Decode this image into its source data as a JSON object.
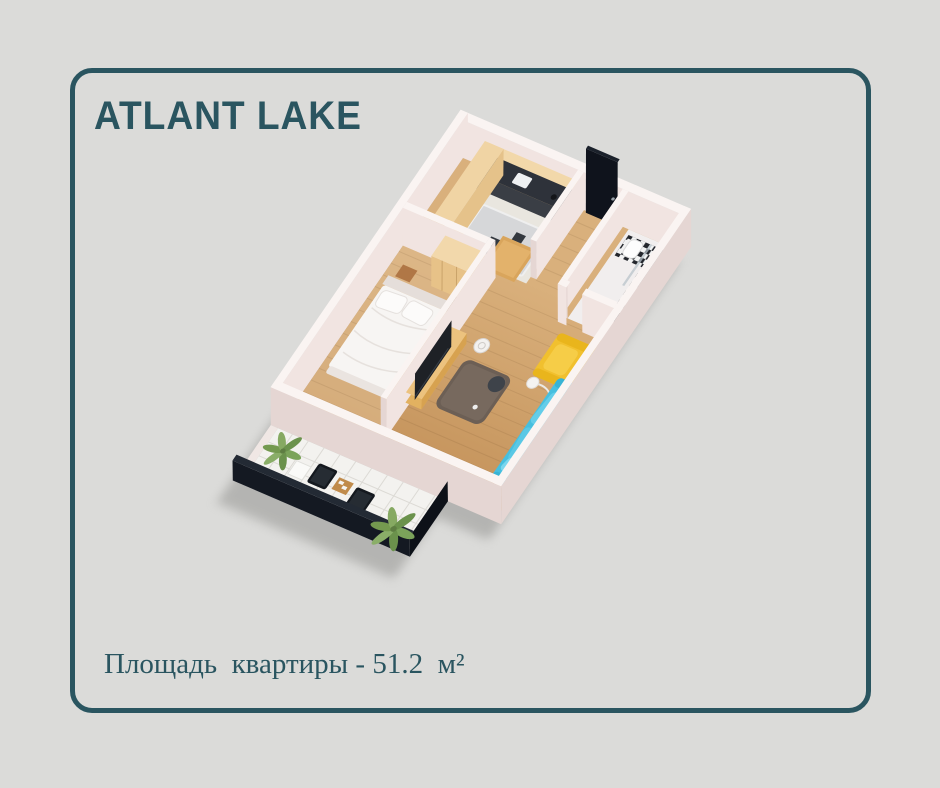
{
  "header": {
    "title": "ATLANT LAKE"
  },
  "footer": {
    "area_label": "Площадь  квартиры - 51.2  м²"
  },
  "palette": {
    "background": "#dbdbd9",
    "accent": "#2a5560",
    "wood_floor_dark": "#c4925a",
    "wood_floor_light": "#d9b07c",
    "bedroom_floor": "#e0bd8f",
    "kitchen_floor": "#e9e6df",
    "bathroom_floor": "#f1eeee",
    "wall_face": "#f1e4e1",
    "wall_top": "#faf4f2",
    "wall_shade": "#e5d6d3",
    "cabinet_wood": "#eac892",
    "counter_dark": "#2e323a",
    "door_dark": "#0f131c",
    "sofa_blue": "#46bfdf",
    "armchair_yellow": "#f1c02e",
    "ottoman_gray": "#6c5f55",
    "tile_white": "#f3f2ef",
    "railing_dark": "#141922",
    "palm_green": "#7ba35a"
  },
  "floorplan": {
    "rooms": [
      "kitchen",
      "hallway",
      "bathroom",
      "bedroom",
      "living-room",
      "balcony"
    ]
  }
}
